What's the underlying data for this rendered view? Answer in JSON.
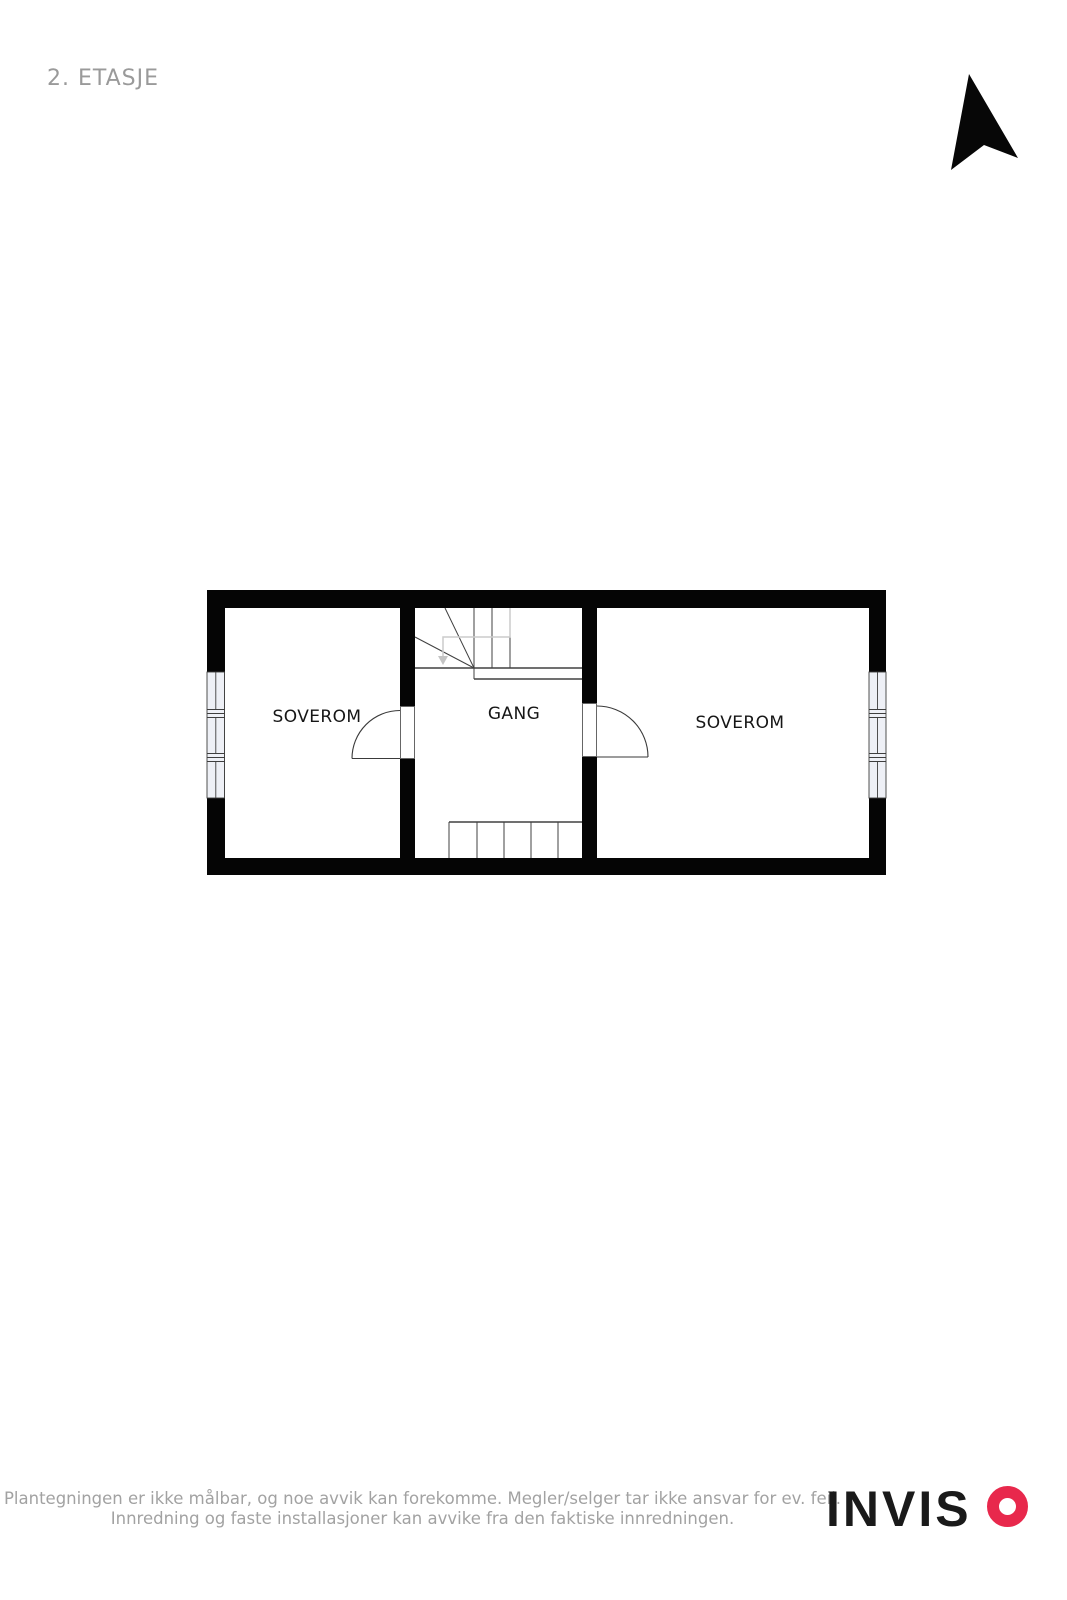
{
  "title": "2. ETASJE",
  "floor_plan": {
    "rooms": [
      {
        "label": "SOVEROM"
      },
      {
        "label": "GANG"
      },
      {
        "label": "SOVEROM"
      }
    ]
  },
  "footer": {
    "disclaimer": {
      "line1": "Plantegningen er ikke målbar, og noe avvik kan forekomme. Megler/selger tar ikke ansvar for ev. feil.",
      "line2": "Innredning og faste installasjoner kan avvike fra den faktiske innredningen."
    },
    "logo": {
      "text": "INVIS",
      "o_color": "#e8284c"
    }
  },
  "colors": {
    "walls": "#000000",
    "title_text": "#9a9a9a",
    "disclaimer_text": "#a2a2a2",
    "logo_text": "#1a1a1a",
    "logo_accent": "#e8284c"
  }
}
